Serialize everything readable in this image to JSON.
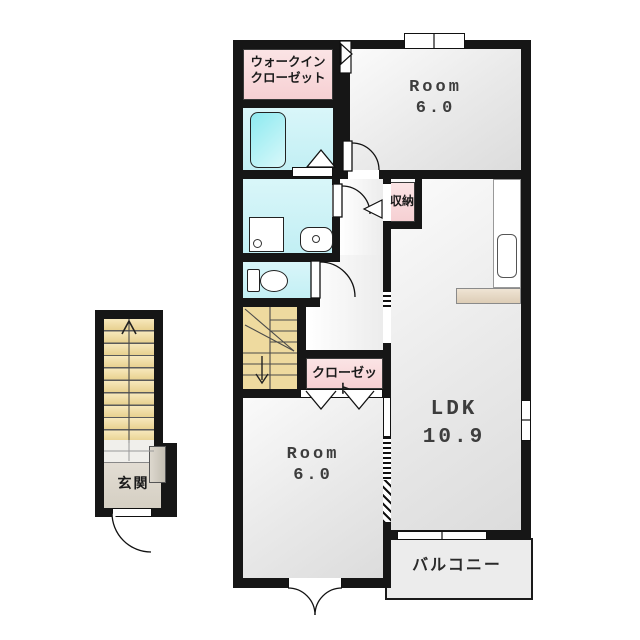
{
  "floor_plan": {
    "type": "japanese-apartment-floor-plan",
    "rooms": {
      "walk_in_closet": {
        "line1": "ウォークイン",
        "line2": "クローゼット"
      },
      "bedroom_top": {
        "name": "Room",
        "size": "6.0"
      },
      "storage": {
        "name": "収納"
      },
      "closet": {
        "name": "クローゼット"
      },
      "bedroom_bottom": {
        "name": "Room",
        "size": "6.0"
      },
      "ldk": {
        "name": "LDK",
        "size": "10.9"
      },
      "balcony": {
        "name": "バルコニー"
      },
      "entrance": {
        "name": "玄関"
      }
    },
    "fixtures": [
      "bathtub",
      "washing-machine-pan",
      "washbasin",
      "toilet",
      "kitchen-counter",
      "kitchen-sink",
      "shoe-cabinet",
      "interior-staircase",
      "exterior-staircase",
      "stairs-up-arrow",
      "stairs-down-arrow"
    ],
    "colors": {
      "wall": "#161616",
      "wet_area_cyan": "#c9f0f5",
      "closet_pink": "#f8d8da",
      "stairs_tan": "#eeda9f",
      "room_grey": "#e8e8e8",
      "counter_tan": "#e4d5c2",
      "balcony_grey": "#ececec"
    }
  }
}
